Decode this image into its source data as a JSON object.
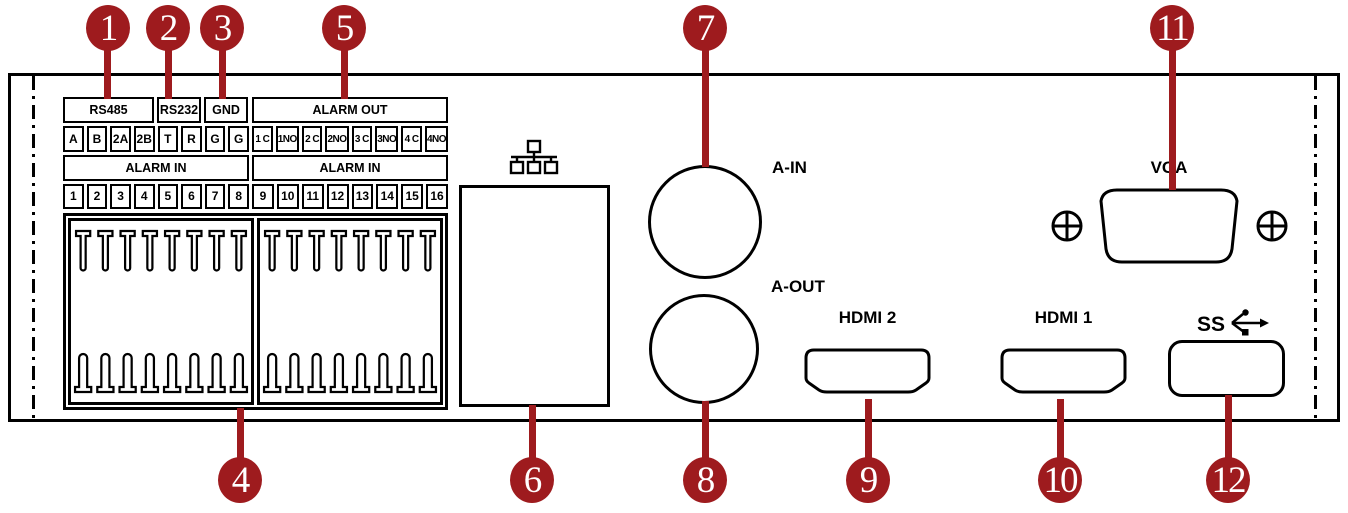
{
  "diagram_title": "DVR rear panel diagram",
  "colors": {
    "callout_red": "#9E1B1E",
    "line_black": "#000000",
    "background": "#FFFFFF"
  },
  "callouts": [
    "1",
    "2",
    "3",
    "4",
    "5",
    "6",
    "7",
    "8",
    "9",
    "10",
    "11",
    "12"
  ],
  "terminal_blocks": {
    "rs485": {
      "header": "RS485",
      "cells": [
        "A",
        "B",
        "2A",
        "2B"
      ]
    },
    "rs232": {
      "header": "RS232",
      "cells": [
        "T",
        "R"
      ]
    },
    "gnd": {
      "header": "GND",
      "cells": [
        "G",
        "G"
      ]
    },
    "alarm_out": {
      "header": "ALARM OUT",
      "cells": [
        "1 C",
        "1NO",
        "2 C",
        "2NO",
        "3 C",
        "3NO",
        "4 C",
        "4NO"
      ]
    },
    "alarm_in_left": {
      "header": "ALARM IN",
      "cells": [
        "1",
        "2",
        "3",
        "4",
        "5",
        "6",
        "7",
        "8"
      ]
    },
    "alarm_in_right": {
      "header": "ALARM IN",
      "cells": [
        "9",
        "10",
        "11",
        "12",
        "13",
        "14",
        "15",
        "16"
      ]
    }
  },
  "port_labels": {
    "audio_in": "A-IN",
    "audio_out": "A-OUT",
    "hdmi2": "HDMI 2",
    "hdmi1": "HDMI 1",
    "vga": "VGA",
    "usb_ss": "SS"
  }
}
